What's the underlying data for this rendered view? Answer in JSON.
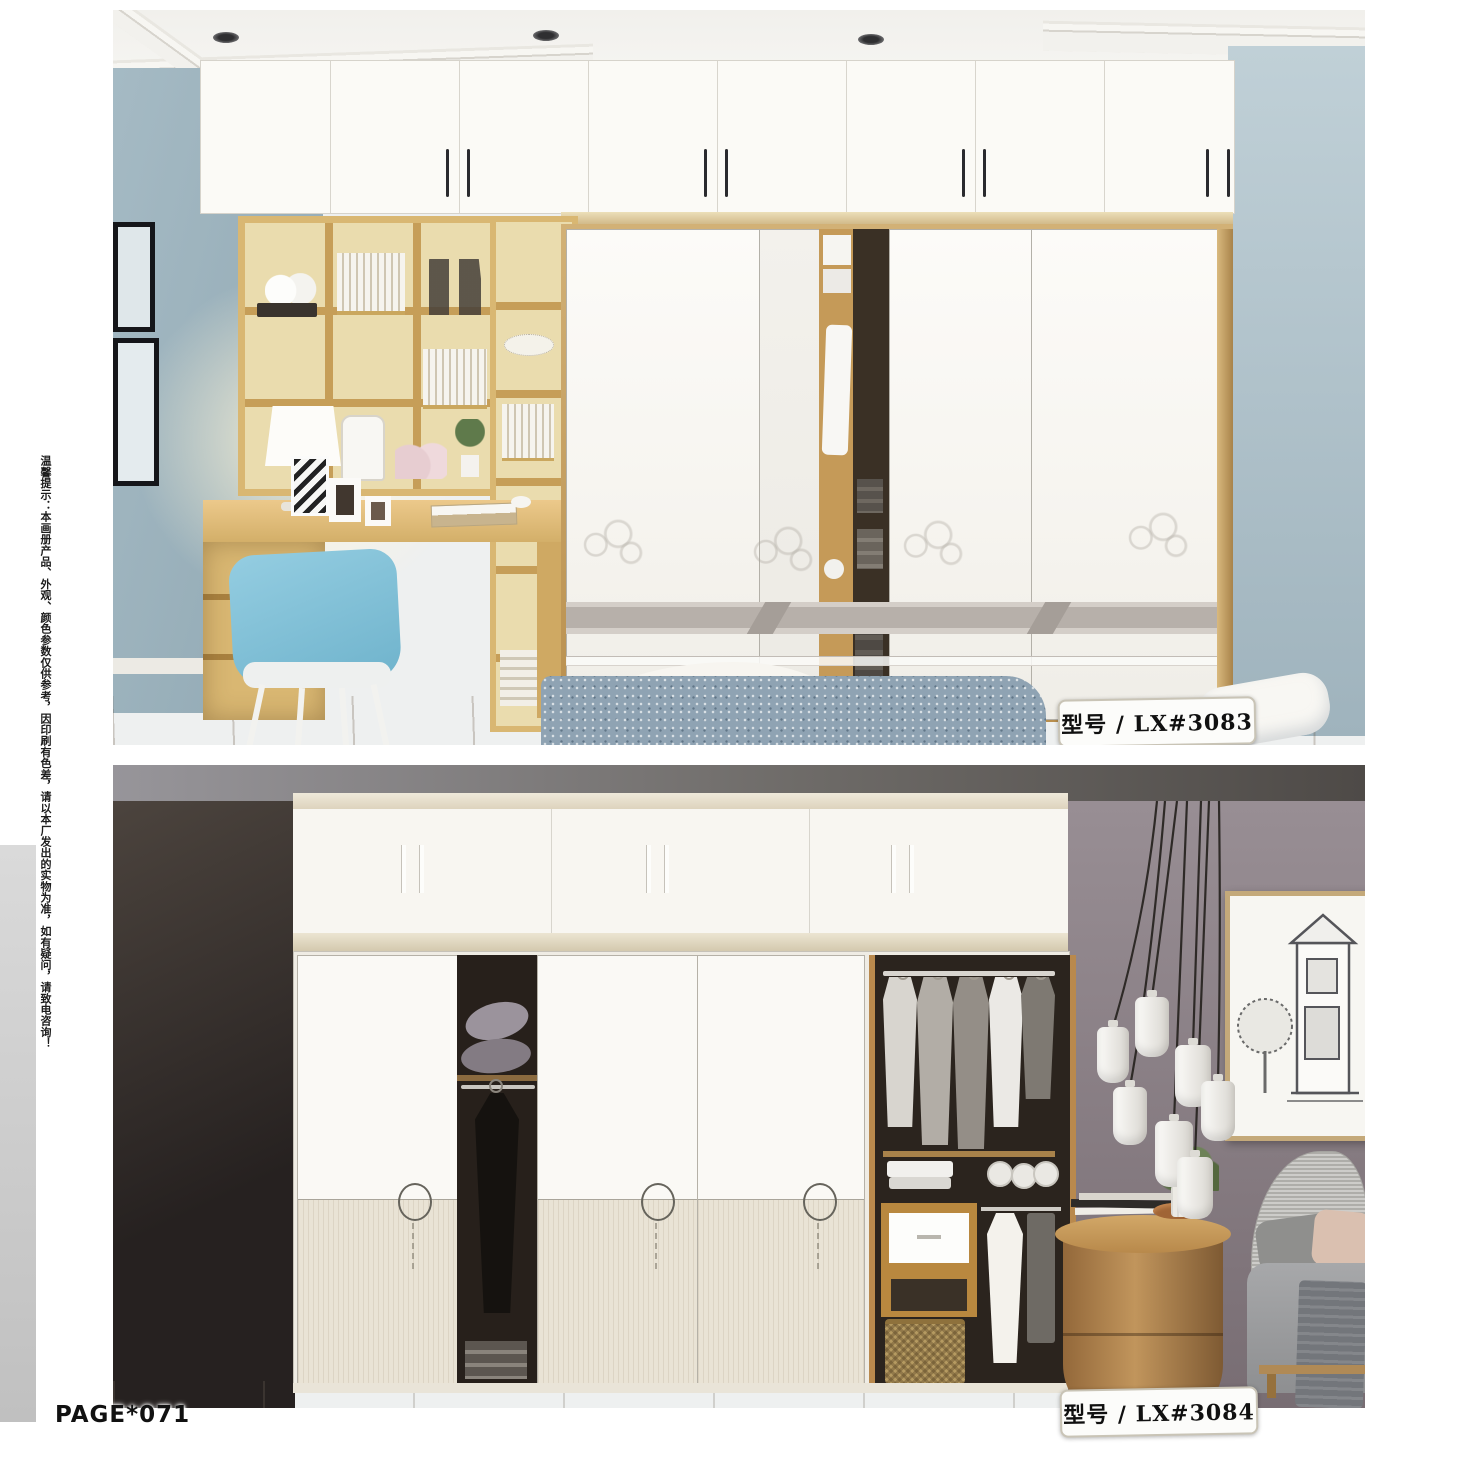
{
  "page": {
    "page_number": "PAGE*071",
    "disclaimer_vertical": "温馨提示：本画册产品、外观、颜色参数仅供参考，因印刷有色差，请以本厂发出的实物为准，如有疑问，请致电咨询！",
    "background": "#ffffff"
  },
  "photos": [
    {
      "model_label": "型号 / LX#3083"
    },
    {
      "model_label": "型号 / LX#3084"
    }
  ],
  "colors": {
    "wood_shelf": "#d9b772",
    "chair_blue": "#7fc0d8",
    "wall_blue_left": "#a5bac4",
    "wall_blue_right": "#bccdd4",
    "door_band_gray": "#b7b0aa",
    "bottom_wall_dark": "#2c2622",
    "bottom_wall_purple": "#8b8187",
    "label_border": "#c9c4b6",
    "label_text": "#101010"
  }
}
